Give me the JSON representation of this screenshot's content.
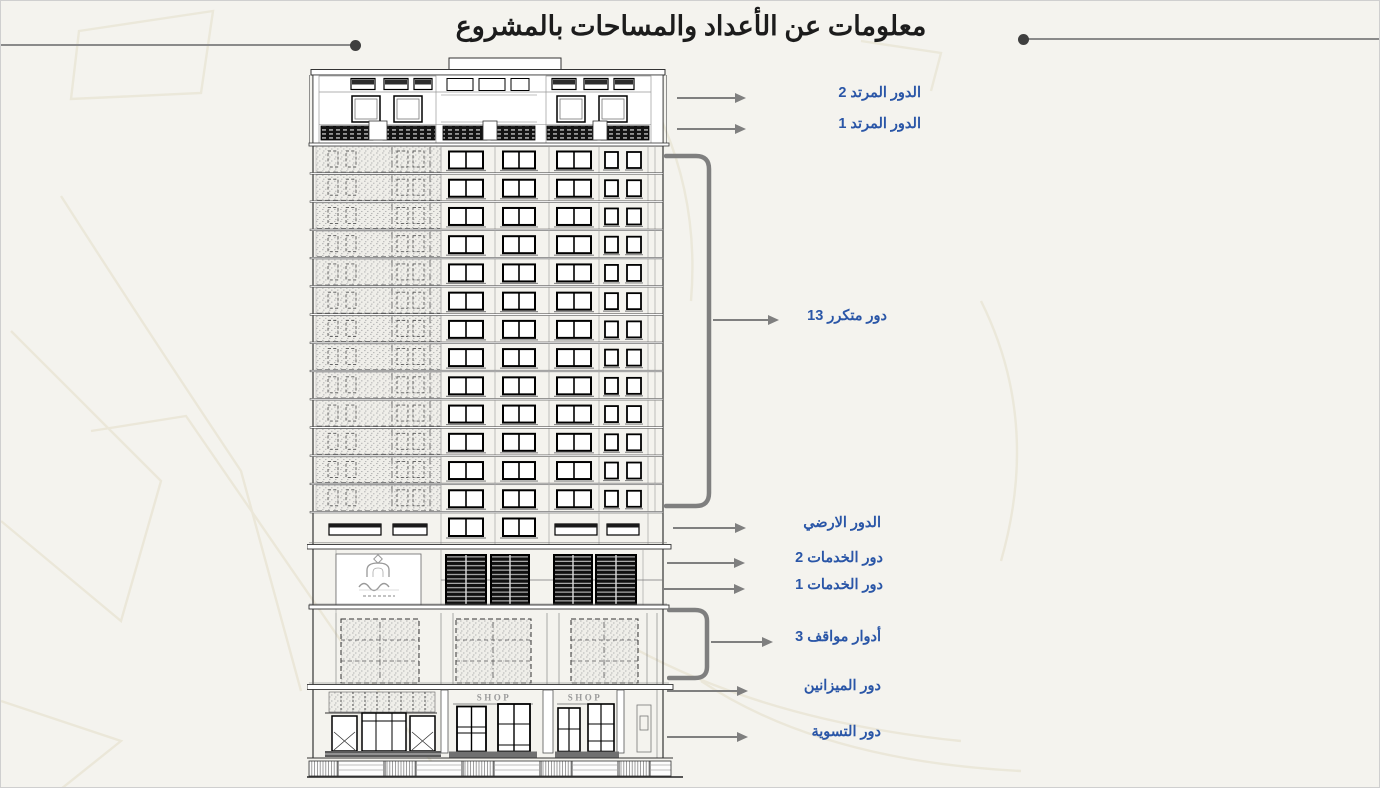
{
  "title": "معلومات عن الأعداد والمساحات بالمشروع",
  "colors": {
    "background": "#f4f3ee",
    "label_blue": "#2a56a7",
    "arrow_gray": "#7f7f7f",
    "title_color": "#1c1c1c"
  },
  "building": {
    "shop_sign": "SHOP"
  },
  "labels": [
    {
      "id": "setback-2",
      "text": "الدور المرتد 2"
    },
    {
      "id": "setback-1",
      "text": "الدور المرتد 1"
    },
    {
      "id": "typical",
      "text": "13 دور متكرر"
    },
    {
      "id": "ground",
      "text": "الدور الارضي"
    },
    {
      "id": "services-2",
      "text": "دور الخدمات 2"
    },
    {
      "id": "services-1",
      "text": "دور الخدمات 1"
    },
    {
      "id": "parking",
      "text": "3 أدوار مواقف"
    },
    {
      "id": "mezzanine",
      "text": "دور الميزانين"
    },
    {
      "id": "basement",
      "text": "دور التسوية"
    }
  ]
}
